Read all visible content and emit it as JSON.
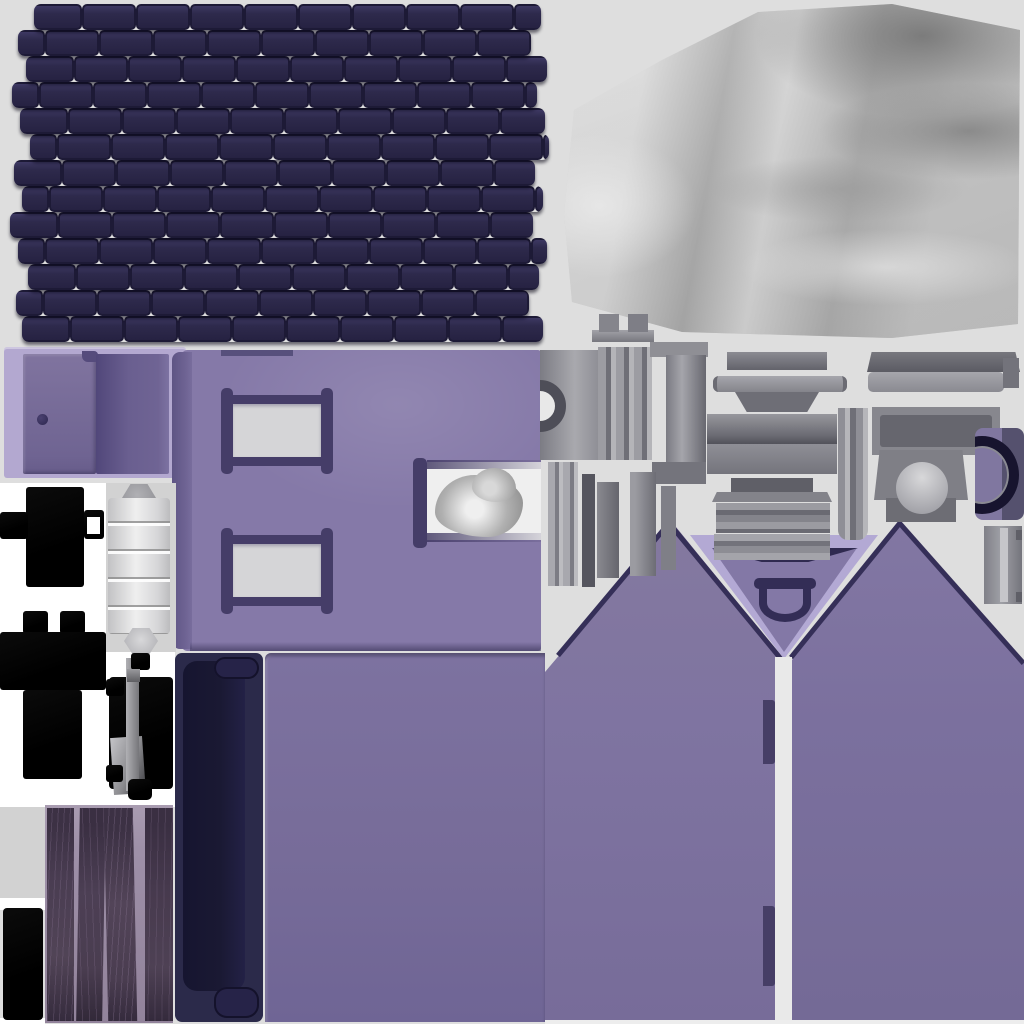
{
  "document": {
    "title": "House model texture atlas",
    "type": "3D UV-baked texture sheet",
    "canvas_size": "1024x1024",
    "visible_text": "none"
  },
  "palette": {
    "bg": "#dedede",
    "white": "#ffffff",
    "panel_gray": "#d2d2d2",
    "roof_base": "#262242",
    "roof_tile": "#2e2a4c",
    "roof_line": "#1d1a36",
    "roof_hi": "#3d3862",
    "fabric_light": "#d4d4d4",
    "fabric_mid": "#b5b5b5",
    "fabric_dark": "#8e8e8e",
    "lavender": "#b3a8d0",
    "door_purple": "#7b6f9e",
    "door_dark": "#655a8a",
    "wall_purple": "#8579a8",
    "wall_edge": "#6b6190",
    "frame_dark": "#453d68",
    "pane_white": "#d5d5d7",
    "navy_piece": "#2b2a4a",
    "navy_inner": "#1a1933",
    "gable_purple": "#7f74a1",
    "gable_trim": "#b3a9d4",
    "v_dark": "#2f2a50",
    "wood_bg": "#9e90a8",
    "wood_plank": "#463a4c",
    "black_part": "#050505",
    "metal_light": "#c0c0c4",
    "metal_mid": "#8d8d92",
    "metal_dark": "#5d5d64",
    "handle_dark": "#17142e",
    "smoke_gray": "#b0b0b0"
  },
  "regions": [
    {
      "name": "roof-shingle-sheet",
      "description": "dark indigo shingle rows, 13 courses, offset brick pattern, wavy edges"
    },
    {
      "name": "fabric-sheet",
      "description": "white-gray silky draped cloth with soft folds, darker shaded upper right"
    },
    {
      "name": "door-panel",
      "description": "lavender backing with two purple door leaves, knob on left leaf"
    },
    {
      "name": "window-wall",
      "description": "purple wall with two white framed windows and a white notch containing a smoke puff"
    },
    {
      "name": "black-bracket-1",
      "description": "black cross-shaped silhouette with square hole in right arm"
    },
    {
      "name": "black-bracket-2",
      "description": "black plus-shaped silhouette with two top tabs"
    },
    {
      "name": "bedroll-cylinder",
      "description": "white banded cylinder with hex caps on gray panel"
    },
    {
      "name": "pedestal-assembly",
      "description": "black pedestal with gray metal column and caps"
    },
    {
      "name": "black-bar",
      "description": "black vertical rectangle, bottom left"
    },
    {
      "name": "wood-plank-strip",
      "description": "four dark purple wood planks with grain on mauve backing"
    },
    {
      "name": "navy-door-side",
      "description": "dark navy slab with inset panel and two pill notches"
    },
    {
      "name": "large-wall",
      "description": "large plain purple wall slab"
    },
    {
      "name": "gable-left",
      "description": "purple gable end wall, peak left of center"
    },
    {
      "name": "gable-right",
      "description": "purple gable end wall, peak right of center"
    },
    {
      "name": "gable-valley-trim",
      "description": "lavender V trim with dark band and arched vent between gables"
    },
    {
      "name": "chimney-parts-left",
      "description": "gray fluted blocks, C-notched block, column with flanges, slats"
    },
    {
      "name": "chimney-parts-center",
      "description": "stack of gray horizontal slabs and bars with legs"
    },
    {
      "name": "chimney-parts-right",
      "description": "gray slabs, dome-front block, hinge strip"
    },
    {
      "name": "handle-plate",
      "description": "purple plate with dark D-shaped handle ring"
    }
  ]
}
